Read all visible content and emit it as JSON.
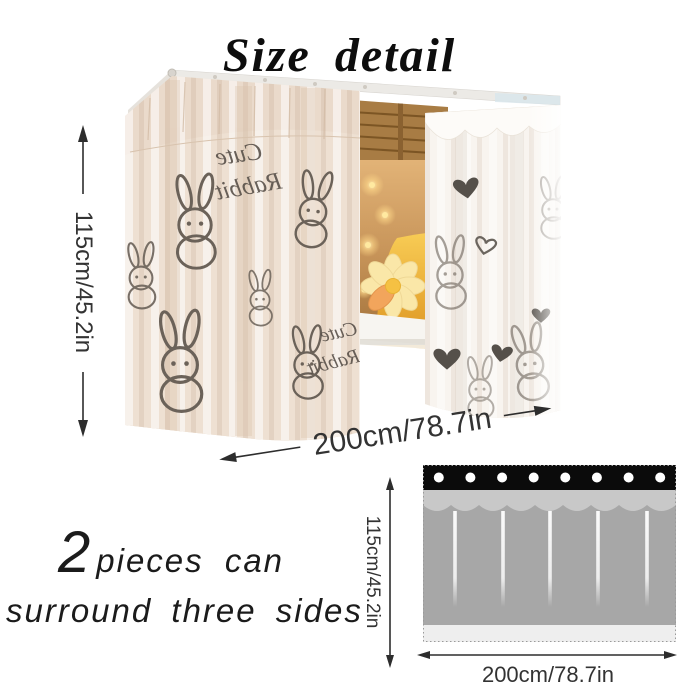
{
  "title": "Size detail",
  "photo": {
    "pattern_text": {
      "word1": "Cute",
      "word2": "Rabbit"
    }
  },
  "photo_dimensions": {
    "height_label": "115cm/45.2in",
    "width_label": "200cm/78.7in"
  },
  "caption": {
    "number": "2",
    "line1_rest": "pieces can",
    "line2": "surround three sides"
  },
  "diagram": {
    "height_label": "115cm/45.2in",
    "width_label": "200cm/78.7in",
    "grommet_count": 8,
    "colors": {
      "header": "#0b0b0b",
      "valance": "#c8c8c8",
      "body": "#a7a7a7",
      "hem": "#eeeeee"
    }
  },
  "colors": {
    "background": "#ffffff",
    "arrow": "#2d2d2d",
    "curtain_cream": "#eee0d2",
    "curtain_white": "#f8f4ef",
    "doodle_ink": "#6b6259"
  }
}
